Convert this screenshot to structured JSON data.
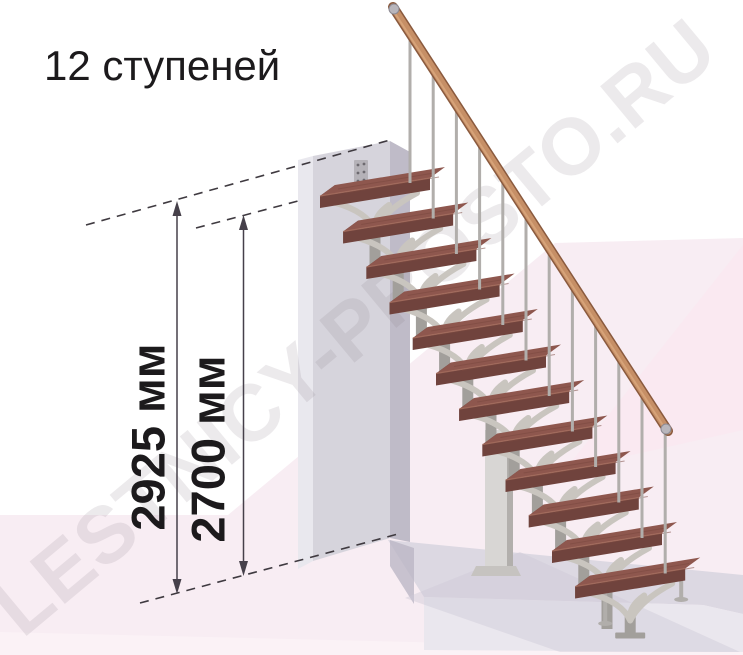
{
  "title": "12 ступеней",
  "watermark": "LESTNICY-PROSTO.RU",
  "dimensions": {
    "total_height": {
      "label": "2925 мм",
      "value": 2925,
      "unit": "мм"
    },
    "floor_to_landing": {
      "label": "2700 мм",
      "value": 2700,
      "unit": "мм"
    }
  },
  "stairs": {
    "step_count": 12,
    "has_handrail": true,
    "description": "modular staircase on central stringer with tree-branch tread supports, wall-mounted top tread, wooden handrail on thin balusters"
  },
  "colors": {
    "background": "#ffffff",
    "floor_pink": "#f8edf3",
    "floor_facet": "#fbe7f0",
    "floor_strip": "#fbf2f6",
    "watermark_gray": "#8a7b87",
    "wall_front": "#d6d4dc",
    "wall_side_left": "#e9e8ee",
    "wall_side_right": "#bfbbc8",
    "wall_bracket": "#b5b2b8",
    "platform_top": "#dcd8e2",
    "platform_front": "#eae7ee",
    "shadow": "#bcb7c6",
    "stair_shadow": "#cfc9d8",
    "tread_top": "#8e574e",
    "tread_front": "#70433d",
    "tread_side": "#5e3733",
    "tread_grain": "#7a483f",
    "tread_edge_highlight": "#a87060",
    "support_post": "#a29f9b",
    "support_arm": "#c9c5bf",
    "column_front": "#d8d6d4",
    "column_side": "#b2afac",
    "column_base": "#c6c3c0",
    "baluster": "#b1aeab",
    "handrail": "#c68f66",
    "handrail_dark": "#8a5a3e",
    "handrail_highlight": "#dba87e",
    "metal_cap": "#b9b6bc",
    "dimension_line": "#46404a",
    "dashed_line": "#3f3a40",
    "text": "#1c1a1c"
  }
}
